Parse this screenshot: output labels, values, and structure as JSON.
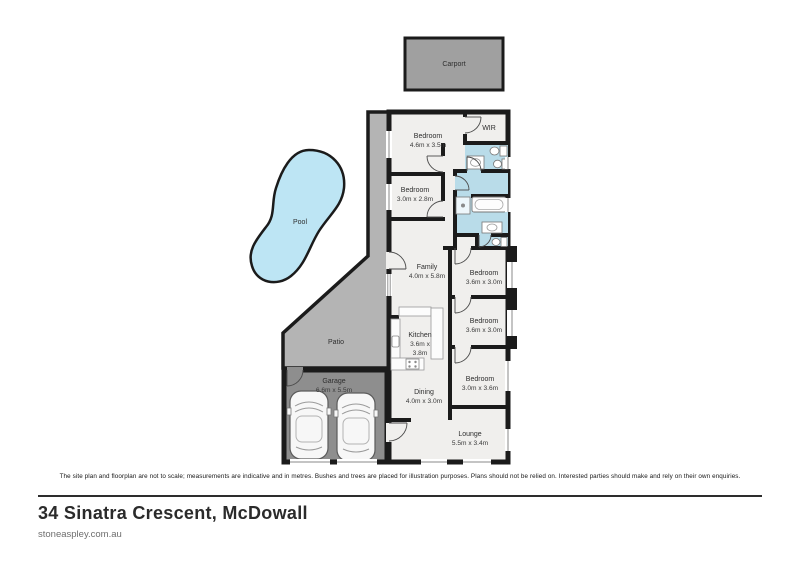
{
  "footer": {
    "disclaimer": "The site plan and floorplan are not to scale; measurements are indicative and in metres. Bushes and trees are placed for illustration purposes. Plans should not be relied on. Interested parties should make and rely on their own enquiries.",
    "address": "34 Sinatra Crescent, McDowall",
    "website": "stoneaspley.com.au"
  },
  "rooms": {
    "carport": {
      "label": "Carport"
    },
    "pool": {
      "label": "Pool"
    },
    "patio": {
      "label": "Patio"
    },
    "garage": {
      "label": "Garage",
      "dims": "6.6m x 5.5m"
    },
    "bedroom_1": {
      "label": "Bedroom",
      "dims": "4.6m x 3.5m"
    },
    "wir": {
      "label": "WIR"
    },
    "bedroom_2": {
      "label": "Bedroom",
      "dims": "3.0m x 2.8m"
    },
    "family": {
      "label": "Family",
      "dims": "4.0m x 5.8m"
    },
    "bedroom_3": {
      "label": "Bedroom",
      "dims": "3.6m x 3.0m"
    },
    "bedroom_4": {
      "label": "Bedroom",
      "dims": "3.6m x 3.0m"
    },
    "kitchen": {
      "label": "Kitchen",
      "dims_lines": [
        "3.6m x",
        "3.8m"
      ]
    },
    "bedroom_5": {
      "label": "Bedroom",
      "dims": "3.0m x 3.6m"
    },
    "dining": {
      "label": "Dining",
      "dims": "4.0m x 3.0m"
    },
    "lounge": {
      "label": "Lounge",
      "dims": "5.5m x 3.4m"
    }
  },
  "colors": {
    "wall": "#1b1b1b",
    "room_fill": "#f0efed",
    "patio_fill": "#b4b4b4",
    "garage_fill": "#8e8e8e",
    "carport_fill": "#a0a0a0",
    "pool_fill": "#bde5f4",
    "bath_fill": "#b9dce9"
  }
}
